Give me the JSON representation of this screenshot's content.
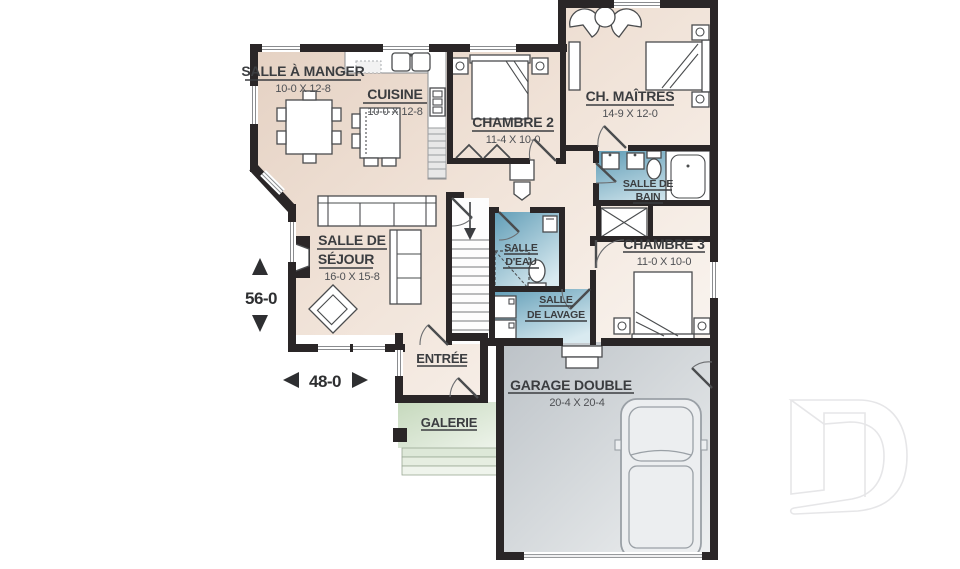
{
  "plan_type": "floor-plan",
  "rooms": {
    "dining": {
      "name": "SALLE À MANGER",
      "dims": "10-0 X 12-8"
    },
    "kitchen": {
      "name": "CUISINE",
      "dims": "10-0 X 12-8"
    },
    "bedroom2": {
      "name": "CHAMBRE 2",
      "dims": "11-4 X 10-0"
    },
    "master": {
      "name": "CH. MAÎTRES",
      "dims": "14-9 X 12-0"
    },
    "bathroom": {
      "line1": "SALLE DE",
      "line2": "BAIN"
    },
    "bedroom3": {
      "name": "CHAMBRE 3",
      "dims": "11-0 X 10-0"
    },
    "living": {
      "line1": "SALLE DE",
      "line2": "SÉJOUR",
      "dims": "16-0 X 15-8"
    },
    "powder": {
      "line1": "SALLE",
      "line2": "D'EAU"
    },
    "laundry": {
      "line1": "SALLE",
      "line2": "DE LAVAGE"
    },
    "entry": {
      "name": "ENTRÉE"
    },
    "porch": {
      "name": "GALERIE"
    },
    "garage": {
      "name": "GARAGE DOUBLE",
      "dims": "20-4 X 20-4"
    }
  },
  "dimensions": {
    "depth": "56-0",
    "width": "48-0"
  },
  "icons": {
    "watermark": "drummond-d-logo",
    "depth_arrows": "up-down-solid-triangles",
    "width_arrows": "left-right-solid-triangles",
    "stairs_arrow": "down-arrow"
  },
  "colors": {
    "wall": "#2a2627",
    "floor_beige_dark": "#e3cfc0",
    "floor_beige_light": "#fbf7f3",
    "wet_room_blue_dark": "#5f9cb6",
    "wet_room_blue_light": "#d9eaf0",
    "porch_green_dark": "#c6d9bd",
    "porch_green_light": "#edf3ea",
    "garage_gray_dark": "#bcc2c7",
    "garage_gray_light": "#eef0f1",
    "label_text": "#3b3d40",
    "watermark_gray": "#e6e6e8"
  }
}
